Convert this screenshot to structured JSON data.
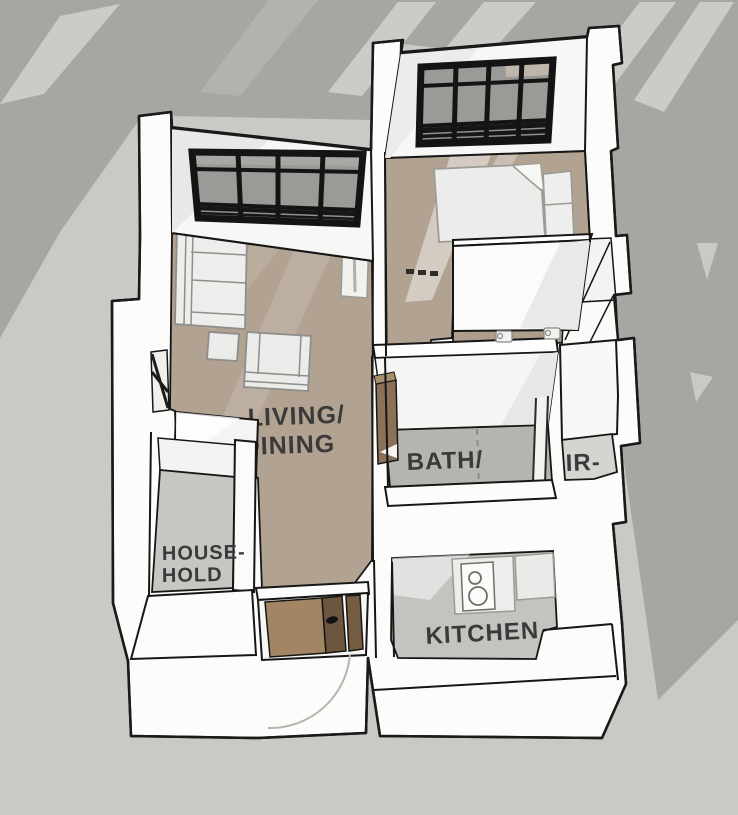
{
  "scene": {
    "description": "3D axonometric floor plan render of an apartment on gray shadowed background",
    "view": "bird's-eye axonometric",
    "background_color": "#c9c9c5",
    "shadow_color": "#a6a6a2",
    "wall_color": "#fcfcfa",
    "outline_color": "#1a1a1a",
    "label_color": "#3a3a3a"
  },
  "rooms": {
    "living": {
      "label_line1": "LIVING/",
      "label_line2": "DINING",
      "floor_color": "#b1a291"
    },
    "bath": {
      "label": "BATH/",
      "floor_color": "#b6b4ae"
    },
    "partial_room": {
      "label": "IR-",
      "floor_color": "#d5d4d0"
    },
    "household": {
      "label_line1": "HOUSE-",
      "label_line2": "HOLD",
      "floor_color": "#c6c6c2"
    },
    "kitchen": {
      "label": "KITCHEN",
      "floor_color": "#c4c3bf"
    }
  },
  "materials": {
    "window_frame": "#141414",
    "window_glass": "#9a9a96",
    "door_wood_light": "#a28663",
    "door_wood_dark": "#6d563f",
    "floor_wood": "#b1a291"
  }
}
